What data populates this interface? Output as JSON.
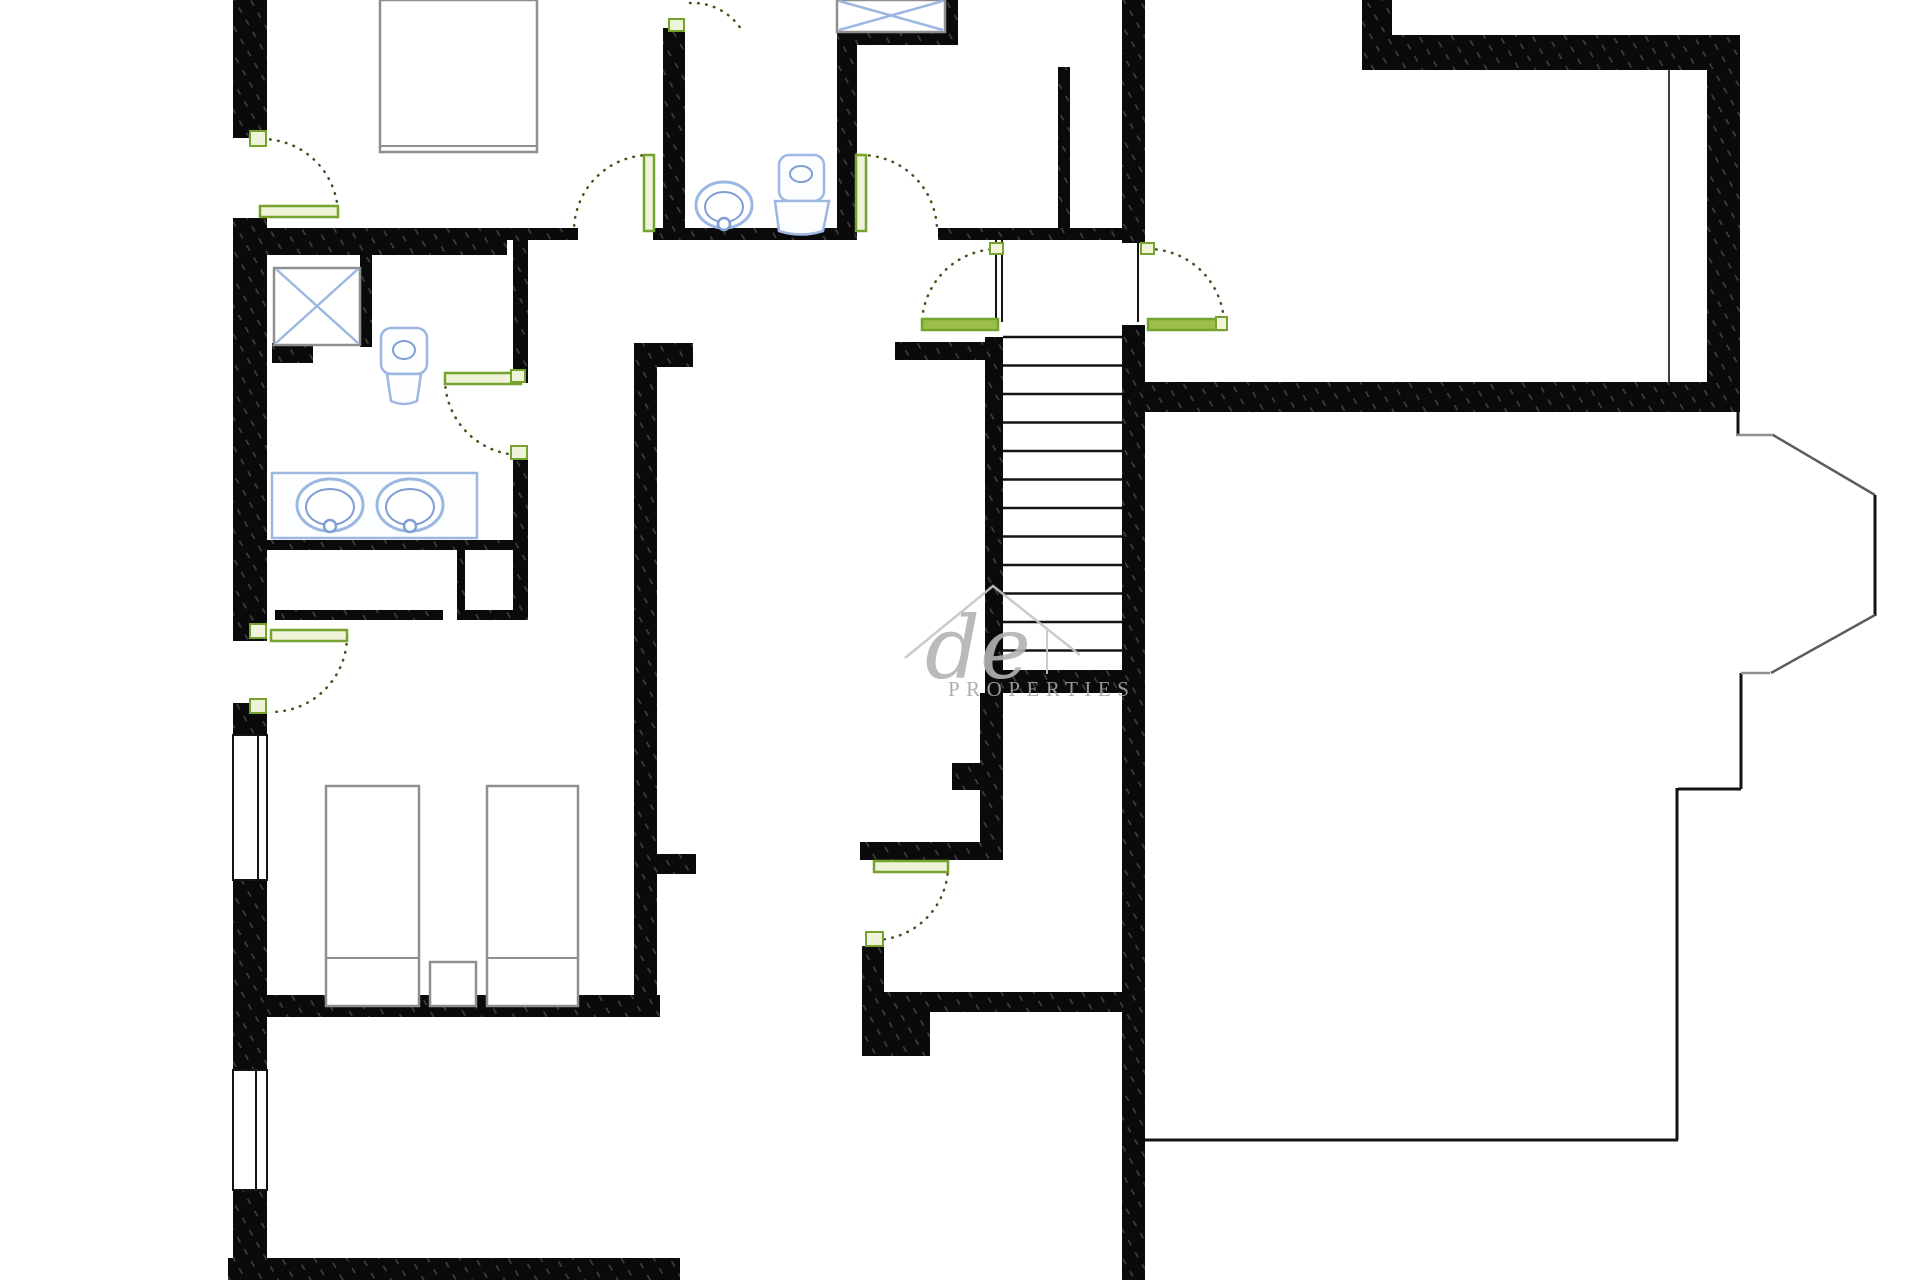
{
  "document": {
    "type": "floor-plan-drawing",
    "background": "#ffffff",
    "canvas": {
      "width": 1920,
      "height": 1280
    }
  },
  "watermark": {
    "script_text": "de",
    "caps_text": "PROPERTIES"
  },
  "colors": {
    "wallBase": "#0a0a0a",
    "hatch": "#ffffff",
    "thin": "#141414",
    "grayLine": "#8f8f8f",
    "diag": "#5d5d5d",
    "innerLine": "#3d3d3d",
    "blue": "#9cb8e2",
    "blue2": "#7d9fd4",
    "fixtureFill": "#fcfdff",
    "green": "#76a22e",
    "greenFill": "#eef3da",
    "greenSolid": "#9cbe4d",
    "arc": "#45521d",
    "wmLine": "#c6c6c6",
    "wmText": "#a6a6a6",
    "wmScript": "#b3b3b3",
    "white": "#ffffff",
    "none": "none"
  },
  "floorplan": {
    "walls": [
      {
        "n": "wall-left-bedroom-top",
        "x": 233,
        "y": 0,
        "w": 34,
        "h": 138
      },
      {
        "n": "wall-left-bathroom",
        "x": 233,
        "y": 218,
        "w": 34,
        "h": 423
      },
      {
        "n": "wall-left-mid",
        "x": 233,
        "y": 703,
        "w": 34,
        "h": 32
      },
      {
        "n": "wall-left-bedroom2-upper",
        "x": 233,
        "y": 880,
        "w": 34,
        "h": 125
      },
      {
        "n": "wall-left-bedroom2-lower",
        "x": 233,
        "y": 1005,
        "w": 34,
        "h": 65
      },
      {
        "n": "wall-left-bottom",
        "x": 233,
        "y": 1190,
        "w": 34,
        "h": 90
      },
      {
        "n": "wall-bottom-left",
        "x": 228,
        "y": 1258,
        "w": 452,
        "h": 22
      },
      {
        "n": "wall-bedroom1-south-thick",
        "x": 267,
        "y": 228,
        "w": 240,
        "h": 27
      },
      {
        "n": "wall-bedroom1-south-thin",
        "x": 507,
        "y": 228,
        "w": 71,
        "h": 12
      },
      {
        "n": "wall-wc-south",
        "x": 653,
        "y": 228,
        "w": 204,
        "h": 12
      },
      {
        "n": "wall-wc-west",
        "x": 663,
        "y": 28,
        "w": 22,
        "h": 203
      },
      {
        "n": "wall-wc-east",
        "x": 837,
        "y": 32,
        "w": 20,
        "h": 199
      },
      {
        "n": "wall-shower-shelf",
        "x": 857,
        "y": 32,
        "w": 101,
        "h": 13
      },
      {
        "n": "wall-shower-east",
        "x": 945,
        "y": 0,
        "w": 13,
        "h": 45
      },
      {
        "n": "wall-landing-north",
        "x": 938,
        "y": 228,
        "w": 184,
        "h": 12
      },
      {
        "n": "wall-entry-stub",
        "x": 1058,
        "y": 67,
        "w": 12,
        "h": 161
      },
      {
        "n": "wall-right-corridor-upper",
        "x": 1122,
        "y": 0,
        "w": 23,
        "h": 243
      },
      {
        "n": "wall-right-corridor-lower",
        "x": 1122,
        "y": 325,
        "w": 23,
        "h": 955
      },
      {
        "n": "wall-hall-stub",
        "x": 895,
        "y": 342,
        "w": 90,
        "h": 18
      },
      {
        "n": "wall-stair-west",
        "x": 985,
        "y": 337,
        "w": 18,
        "h": 356
      },
      {
        "n": "wall-stair-south",
        "x": 985,
        "y": 670,
        "w": 160,
        "h": 23
      },
      {
        "n": "wall-understair-west",
        "x": 980,
        "y": 693,
        "w": 23,
        "h": 150
      },
      {
        "n": "wall-understair-notch",
        "x": 952,
        "y": 763,
        "w": 28,
        "h": 27
      },
      {
        "n": "wall-lowerhall-north",
        "x": 860,
        "y": 842,
        "w": 143,
        "h": 18
      },
      {
        "n": "wall-lowerroom-west",
        "x": 862,
        "y": 946,
        "w": 22,
        "h": 66
      },
      {
        "n": "wall-lowerroom-north",
        "x": 884,
        "y": 992,
        "w": 238,
        "h": 20
      },
      {
        "n": "wall-lowerroom-pier",
        "x": 862,
        "y": 1012,
        "w": 68,
        "h": 44
      },
      {
        "n": "wall-corridor-west-upper",
        "x": 513,
        "y": 230,
        "w": 15,
        "h": 153
      },
      {
        "n": "wall-corridor-west-lower",
        "x": 513,
        "y": 450,
        "w": 15,
        "h": 170
      },
      {
        "n": "wall-closet-north",
        "x": 265,
        "y": 540,
        "w": 262,
        "h": 10
      },
      {
        "n": "wall-closet-divider",
        "x": 457,
        "y": 550,
        "w": 8,
        "h": 70
      },
      {
        "n": "wall-closet-south-left",
        "x": 275,
        "y": 610,
        "w": 168,
        "h": 10
      },
      {
        "n": "wall-closet-south-right",
        "x": 465,
        "y": 610,
        "w": 48,
        "h": 10
      },
      {
        "n": "wall-under-shower",
        "x": 272,
        "y": 343,
        "w": 41,
        "h": 20
      },
      {
        "n": "wall-shower2-east",
        "x": 360,
        "y": 255,
        "w": 12,
        "h": 92
      },
      {
        "n": "wall-bedroom2-east",
        "x": 634,
        "y": 343,
        "w": 23,
        "h": 665
      },
      {
        "n": "wall-bedroom2-east-stub-top",
        "x": 634,
        "y": 343,
        "w": 59,
        "h": 24
      },
      {
        "n": "wall-bedroom2-east-stub",
        "x": 657,
        "y": 854,
        "w": 39,
        "h": 20
      },
      {
        "n": "wall-bedroom2-south",
        "x": 265,
        "y": 995,
        "w": 395,
        "h": 22
      },
      {
        "n": "wall-topright-stub",
        "x": 1362,
        "y": 0,
        "w": 30,
        "h": 35
      },
      {
        "n": "wall-topright-north",
        "x": 1362,
        "y": 35,
        "w": 378,
        "h": 35
      },
      {
        "n": "wall-topright-east",
        "x": 1707,
        "y": 35,
        "w": 33,
        "h": 377
      },
      {
        "n": "wall-topright-south",
        "x": 1145,
        "y": 382,
        "w": 595,
        "h": 30
      }
    ],
    "thin_lines": [
      {
        "n": "line-bottomright-north",
        "x1": 1145,
        "y1": 1140,
        "x2": 1678,
        "y2": 1140,
        "s": "thin",
        "sw": 3
      },
      {
        "n": "line-bottomright-east",
        "x1": 1677,
        "y1": 788,
        "x2": 1677,
        "y2": 1140,
        "s": "thin",
        "sw": 3
      },
      {
        "n": "line-bottomright-step",
        "x1": 1678,
        "y1": 789,
        "x2": 1741,
        "y2": 789,
        "s": "thin",
        "sw": 3
      },
      {
        "n": "line-bay-south-leg",
        "x1": 1741,
        "y1": 673,
        "x2": 1741,
        "y2": 789,
        "s": "thin",
        "sw": 3
      },
      {
        "n": "line-bay-north-leg",
        "x1": 1738,
        "y1": 412,
        "x2": 1738,
        "y2": 436,
        "s": "thin",
        "sw": 3
      },
      {
        "n": "line-bay-north",
        "x1": 1737,
        "y1": 435,
        "x2": 1774,
        "y2": 435,
        "s": "grayLine",
        "sw": 2.5
      },
      {
        "n": "line-bay-diag-top",
        "x1": 1773,
        "y1": 435,
        "x2": 1875,
        "y2": 495,
        "s": "diag",
        "sw": 2.5
      },
      {
        "n": "line-bay-east",
        "x1": 1875,
        "y1": 495,
        "x2": 1875,
        "y2": 616,
        "s": "thin",
        "sw": 3
      },
      {
        "n": "line-bay-diag-bottom",
        "x1": 1875,
        "y1": 615,
        "x2": 1771,
        "y2": 673,
        "s": "diag",
        "sw": 2.5
      },
      {
        "n": "line-bay-south",
        "x1": 1770,
        "y1": 673,
        "x2": 1741,
        "y2": 673,
        "s": "grayLine",
        "sw": 2.5
      },
      {
        "n": "line-topright-inner",
        "x1": 1669,
        "y1": 70,
        "x2": 1669,
        "y2": 382,
        "s": "innerLine",
        "sw": 2
      },
      {
        "n": "line-door-jamb-left-a",
        "x1": 996,
        "y1": 240,
        "x2": 996,
        "y2": 322,
        "s": "thin",
        "sw": 2
      },
      {
        "n": "line-door-jamb-left-b",
        "x1": 1002,
        "y1": 240,
        "x2": 1002,
        "y2": 322,
        "s": "thin",
        "sw": 2
      },
      {
        "n": "line-door-jamb-right",
        "x1": 1138,
        "y1": 240,
        "x2": 1138,
        "y2": 322,
        "s": "thin",
        "sw": 2
      }
    ],
    "windows": [
      {
        "n": "window-left-1",
        "x": 233,
        "y": 735,
        "w": 34,
        "h": 145,
        "inner_x": 258
      },
      {
        "n": "window-left-2",
        "x": 233,
        "y": 1070,
        "w": 34,
        "h": 120,
        "inner_x": 256
      }
    ],
    "stairs": {
      "n": "staircase",
      "x1": 1003,
      "x2": 1122,
      "y_start": 337,
      "step": 28.5,
      "count": 12,
      "sw": 2.5
    },
    "doors": [
      {
        "n": "door-bedroom1",
        "markers": [
          {
            "x": 250,
            "y": 131,
            "w": 16,
            "h": 15
          }
        ],
        "leaf": {
          "x": 260,
          "y": 206,
          "w": 78,
          "h": 11,
          "f": "greenFill"
        },
        "arc": "M 262,139 A 76,76 0 0 1 338,215"
      },
      {
        "n": "door-bedroom2",
        "markers": [
          {
            "x": 250,
            "y": 624,
            "w": 16,
            "h": 14
          },
          {
            "x": 250,
            "y": 699,
            "w": 16,
            "h": 14
          }
        ],
        "leaf": {
          "x": 271,
          "y": 630,
          "w": 76,
          "h": 11,
          "f": "greenFill"
        },
        "arc": "M 347,636 A 76,76 0 0 1 271,712"
      },
      {
        "n": "door-hall-west",
        "markers": [],
        "leaf": {
          "x": 644,
          "y": 155,
          "w": 10,
          "h": 76,
          "f": "greenFill"
        },
        "arc": "M 650,155 A 76,76 0 0 0 574,231"
      },
      {
        "n": "door-wc-top",
        "markers": [
          {
            "x": 669,
            "y": 19,
            "w": 15,
            "h": 12
          }
        ],
        "leaf": null,
        "arc": "M 690,3 A 58,58 0 0 1 741,29"
      },
      {
        "n": "door-wc",
        "markers": [],
        "leaf": {
          "x": 856,
          "y": 155,
          "w": 10,
          "h": 76,
          "f": "greenFill"
        },
        "arc": "M 861,155 A 76,76 0 0 1 937,231"
      },
      {
        "n": "door-landing-left",
        "markers": [
          {
            "x": 990,
            "y": 243,
            "w": 13,
            "h": 11
          }
        ],
        "leaf": {
          "x": 922,
          "y": 319,
          "w": 76,
          "h": 11,
          "f": "greenSolid"
        },
        "arc": "M 998,249 A 76,76 0 0 0 922,325"
      },
      {
        "n": "door-landing-right",
        "markers": [
          {
            "x": 1141,
            "y": 243,
            "w": 13,
            "h": 11
          },
          {
            "x": 1216,
            "y": 317,
            "w": 11,
            "h": 13
          }
        ],
        "leaf": {
          "x": 1148,
          "y": 319,
          "w": 76,
          "h": 11,
          "f": "greenSolid"
        },
        "arc": "M 1148,249 A 76,76 0 0 1 1224,325"
      },
      {
        "n": "door-lower-room",
        "markers": [
          {
            "x": 866,
            "y": 932,
            "w": 17,
            "h": 14
          }
        ],
        "leaf": {
          "x": 874,
          "y": 861,
          "w": 74,
          "h": 11,
          "f": "greenFill"
        },
        "arc": "M 948,866 A 74,74 0 0 1 874,940"
      },
      {
        "n": "door-bathroom",
        "markers": [
          {
            "x": 511,
            "y": 370,
            "w": 14,
            "h": 12
          },
          {
            "x": 511,
            "y": 446,
            "w": 16,
            "h": 13
          }
        ],
        "leaf": {
          "x": 445,
          "y": 373,
          "w": 76,
          "h": 11,
          "f": "greenFill"
        },
        "arc": "M 445,379 A 76,76 0 0 0 521,455"
      }
    ],
    "fixtures": {
      "showers": [
        {
          "n": "shower-top",
          "x": 837,
          "y": 0,
          "w": 108,
          "h": 32
        },
        {
          "n": "shower-bathroom",
          "x": 274,
          "y": 268,
          "w": 86,
          "h": 77
        }
      ],
      "sinks": [
        {
          "n": "sink-wc",
          "cx": 724,
          "cy": 205,
          "rx": 28,
          "ry": 23,
          "irx": 19,
          "iry": 15,
          "tap_y": 224
        },
        {
          "n": "sink-vanity-left",
          "cx": 330,
          "cy": 505,
          "rx": 33,
          "ry": 26,
          "irx": 24,
          "iry": 18,
          "tap_y": 526
        },
        {
          "n": "sink-vanity-right",
          "cx": 410,
          "cy": 505,
          "rx": 33,
          "ry": 26,
          "irx": 24,
          "iry": 18,
          "tap_y": 526
        }
      ],
      "vanity": {
        "n": "vanity-counter",
        "x": 272,
        "y": 473,
        "w": 205,
        "h": 65
      },
      "toilets": [
        {
          "n": "toilet-wc",
          "tank": {
            "x": 779,
            "y": 155,
            "w": 45,
            "h": 46
          },
          "oval": {
            "cx": 801,
            "cy": 174,
            "rx": 11,
            "ry": 8
          },
          "bowl": "M 775,201 L 829,201 L 823,231 Q 801,238 779,231 Z"
        },
        {
          "n": "toilet-bathroom",
          "tank": {
            "x": 381,
            "y": 328,
            "w": 46,
            "h": 46
          },
          "oval": {
            "cx": 404,
            "cy": 350,
            "rx": 11,
            "ry": 9
          },
          "bowl": "M 387,374 L 421,374 L 417,401 Q 404,407 391,401 Z"
        }
      ]
    },
    "furniture": [
      {
        "n": "bed-top",
        "x": 380,
        "y": 0,
        "w": 157,
        "h": 152,
        "line_y": 146
      },
      {
        "n": "bed-twin-left",
        "x": 326,
        "y": 786,
        "w": 93,
        "h": 220,
        "line_y": 958
      },
      {
        "n": "bed-twin-right",
        "x": 487,
        "y": 786,
        "w": 91,
        "h": 220,
        "line_y": 958
      },
      {
        "n": "nightstand",
        "x": 430,
        "y": 962,
        "w": 46,
        "h": 44,
        "line_y": null
      }
    ],
    "watermark_graphics": {
      "roof_path": "M 905,658 L 993,586 L 1080,655",
      "tick": {
        "x1": 1047,
        "y1": 630,
        "x2": 1047,
        "y2": 674
      },
      "script": {
        "x": 925,
        "y": 678,
        "size": 86
      },
      "caps": {
        "x": 948,
        "y": 696,
        "size": 21,
        "ls": 6.5
      }
    }
  }
}
